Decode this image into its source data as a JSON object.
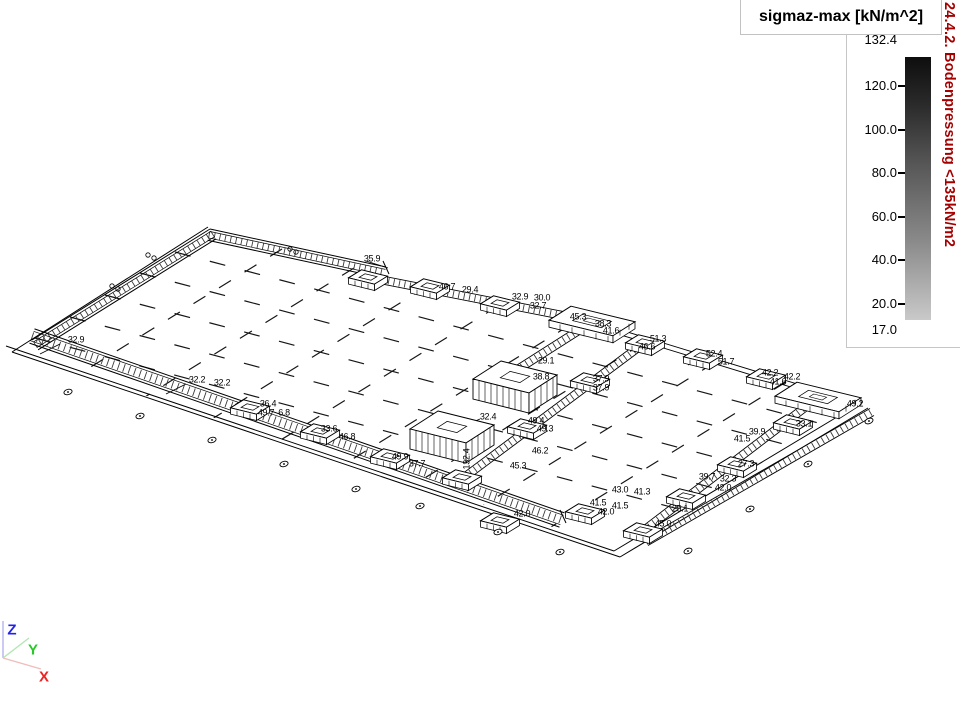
{
  "legend": {
    "title": "sigmaz-max [kN/m^2]",
    "max_label": "132.4",
    "min_label": "17.0",
    "ticks": [
      {
        "label": "120.0",
        "y": 86
      },
      {
        "label": "100.0",
        "y": 130
      },
      {
        "label": "80.0",
        "y": 173
      },
      {
        "label": "60.0",
        "y": 217
      },
      {
        "label": "40.0",
        "y": 260
      },
      {
        "label": "20.0",
        "y": 304
      }
    ],
    "bar_top_color": "#0e0e0e",
    "bar_bottom_color": "#c9c9c9"
  },
  "side_note": {
    "text": "24.4.2. Bodenpressung <135kN/m2",
    "color": "#a50000"
  },
  "axes_triad": {
    "z": "Z",
    "y": "Y",
    "x": "X",
    "z_color": "#2222ee",
    "y_color": "#28c828",
    "x_color": "#ee2222"
  },
  "drawing": {
    "labels": [
      {
        "t": "32.9",
        "x": 76,
        "y": 340
      },
      {
        "t": "32.2",
        "x": 197,
        "y": 380
      },
      {
        "t": "32.2",
        "x": 222,
        "y": 383
      },
      {
        "t": "36.4",
        "x": 268,
        "y": 404
      },
      {
        "t": "49.7",
        "x": 266,
        "y": 413
      },
      {
        "t": "6.8",
        "x": 284,
        "y": 413
      },
      {
        "t": "33.6",
        "x": 329,
        "y": 429
      },
      {
        "t": "46.8",
        "x": 347,
        "y": 437
      },
      {
        "t": "49.9",
        "x": 400,
        "y": 457
      },
      {
        "t": "37.7",
        "x": 417,
        "y": 464
      },
      {
        "t": "35.9",
        "x": 372,
        "y": 259
      },
      {
        "t": "46.7",
        "x": 447,
        "y": 287
      },
      {
        "t": "29.4",
        "x": 470,
        "y": 290
      },
      {
        "t": "32.9",
        "x": 520,
        "y": 297
      },
      {
        "t": "30.0",
        "x": 542,
        "y": 298
      },
      {
        "t": "32.7",
        "x": 538,
        "y": 306
      },
      {
        "t": "45.3",
        "x": 578,
        "y": 317
      },
      {
        "t": "38.3",
        "x": 603,
        "y": 324
      },
      {
        "t": "41.6",
        "x": 611,
        "y": 331
      },
      {
        "t": "51.3",
        "x": 658,
        "y": 339
      },
      {
        "t": "46.6",
        "x": 647,
        "y": 347
      },
      {
        "t": "52.4",
        "x": 714,
        "y": 354
      },
      {
        "t": "51.7",
        "x": 726,
        "y": 362
      },
      {
        "t": "42.2",
        "x": 770,
        "y": 373
      },
      {
        "t": "42.2",
        "x": 792,
        "y": 377
      },
      {
        "t": "41.6",
        "x": 778,
        "y": 382
      },
      {
        "t": "49.2",
        "x": 855,
        "y": 404
      },
      {
        "t": "29.1",
        "x": 546,
        "y": 361
      },
      {
        "t": "38.8",
        "x": 541,
        "y": 377
      },
      {
        "t": "37.9",
        "x": 601,
        "y": 379
      },
      {
        "t": "37.9",
        "x": 601,
        "y": 388
      },
      {
        "t": "32.4",
        "x": 488,
        "y": 417
      },
      {
        "t": "132.4",
        "x": 467,
        "y": 459,
        "r": -90
      },
      {
        "t": "49.4",
        "x": 536,
        "y": 421
      },
      {
        "t": "49.3",
        "x": 545,
        "y": 429
      },
      {
        "t": "46.2",
        "x": 540,
        "y": 451
      },
      {
        "t": "45.3",
        "x": 518,
        "y": 466
      },
      {
        "t": "33.1",
        "x": 804,
        "y": 424
      },
      {
        "t": "39.9",
        "x": 757,
        "y": 432
      },
      {
        "t": "41.5",
        "x": 742,
        "y": 439
      },
      {
        "t": "27.3",
        "x": 746,
        "y": 464
      },
      {
        "t": "39.7",
        "x": 707,
        "y": 477
      },
      {
        "t": "32.3",
        "x": 728,
        "y": 479
      },
      {
        "t": "42.0",
        "x": 723,
        "y": 488
      },
      {
        "t": "25.1",
        "x": 680,
        "y": 509
      },
      {
        "t": "45.0",
        "x": 663,
        "y": 524
      },
      {
        "t": "43.0",
        "x": 620,
        "y": 490
      },
      {
        "t": "41.3",
        "x": 642,
        "y": 492
      },
      {
        "t": "41.5",
        "x": 598,
        "y": 503
      },
      {
        "t": "41.5",
        "x": 620,
        "y": 506
      },
      {
        "t": "42.0",
        "x": 606,
        "y": 512
      },
      {
        "t": "42.0",
        "x": 522,
        "y": 514
      }
    ]
  }
}
